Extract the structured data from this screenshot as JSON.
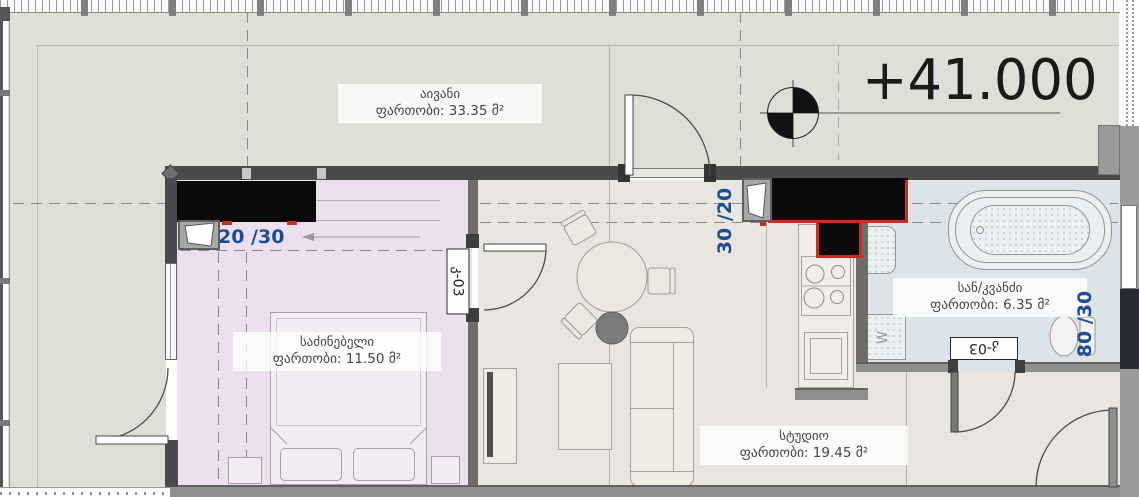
{
  "elevation": {
    "value": "+41.000"
  },
  "rooms": {
    "balcony": {
      "name": "აივანი",
      "area": "ფართობი: 33.35 მ²"
    },
    "bedroom": {
      "name": "საძინებელი",
      "area": "ფართობი: 11.50 მ²"
    },
    "studio": {
      "name": "სტუდიო",
      "area": "ფართობი: 19.45 მ²"
    },
    "bathroom": {
      "name": "სან/კვანძი",
      "area": "ფართობი: 6.35 მ²"
    }
  },
  "dimensions": {
    "bedroom_shaft": "20 /30",
    "kitchen_shaft": "30 /20",
    "bathroom_shaft": "80 /30"
  },
  "door_tags": {
    "bedroom_door": "კ-03",
    "bathroom_door": "კ-03"
  },
  "appliances": {
    "washer_label": "W"
  },
  "colors": {
    "terrace": "#dce0d7",
    "bedroom": "#ecdfee",
    "studio": "#e9e5e0",
    "bathroom": "#dce4ea",
    "dimension_text": "#1d4f8e",
    "shaft_fill": "#0a0a0a",
    "accent_red": "#c92d20"
  }
}
